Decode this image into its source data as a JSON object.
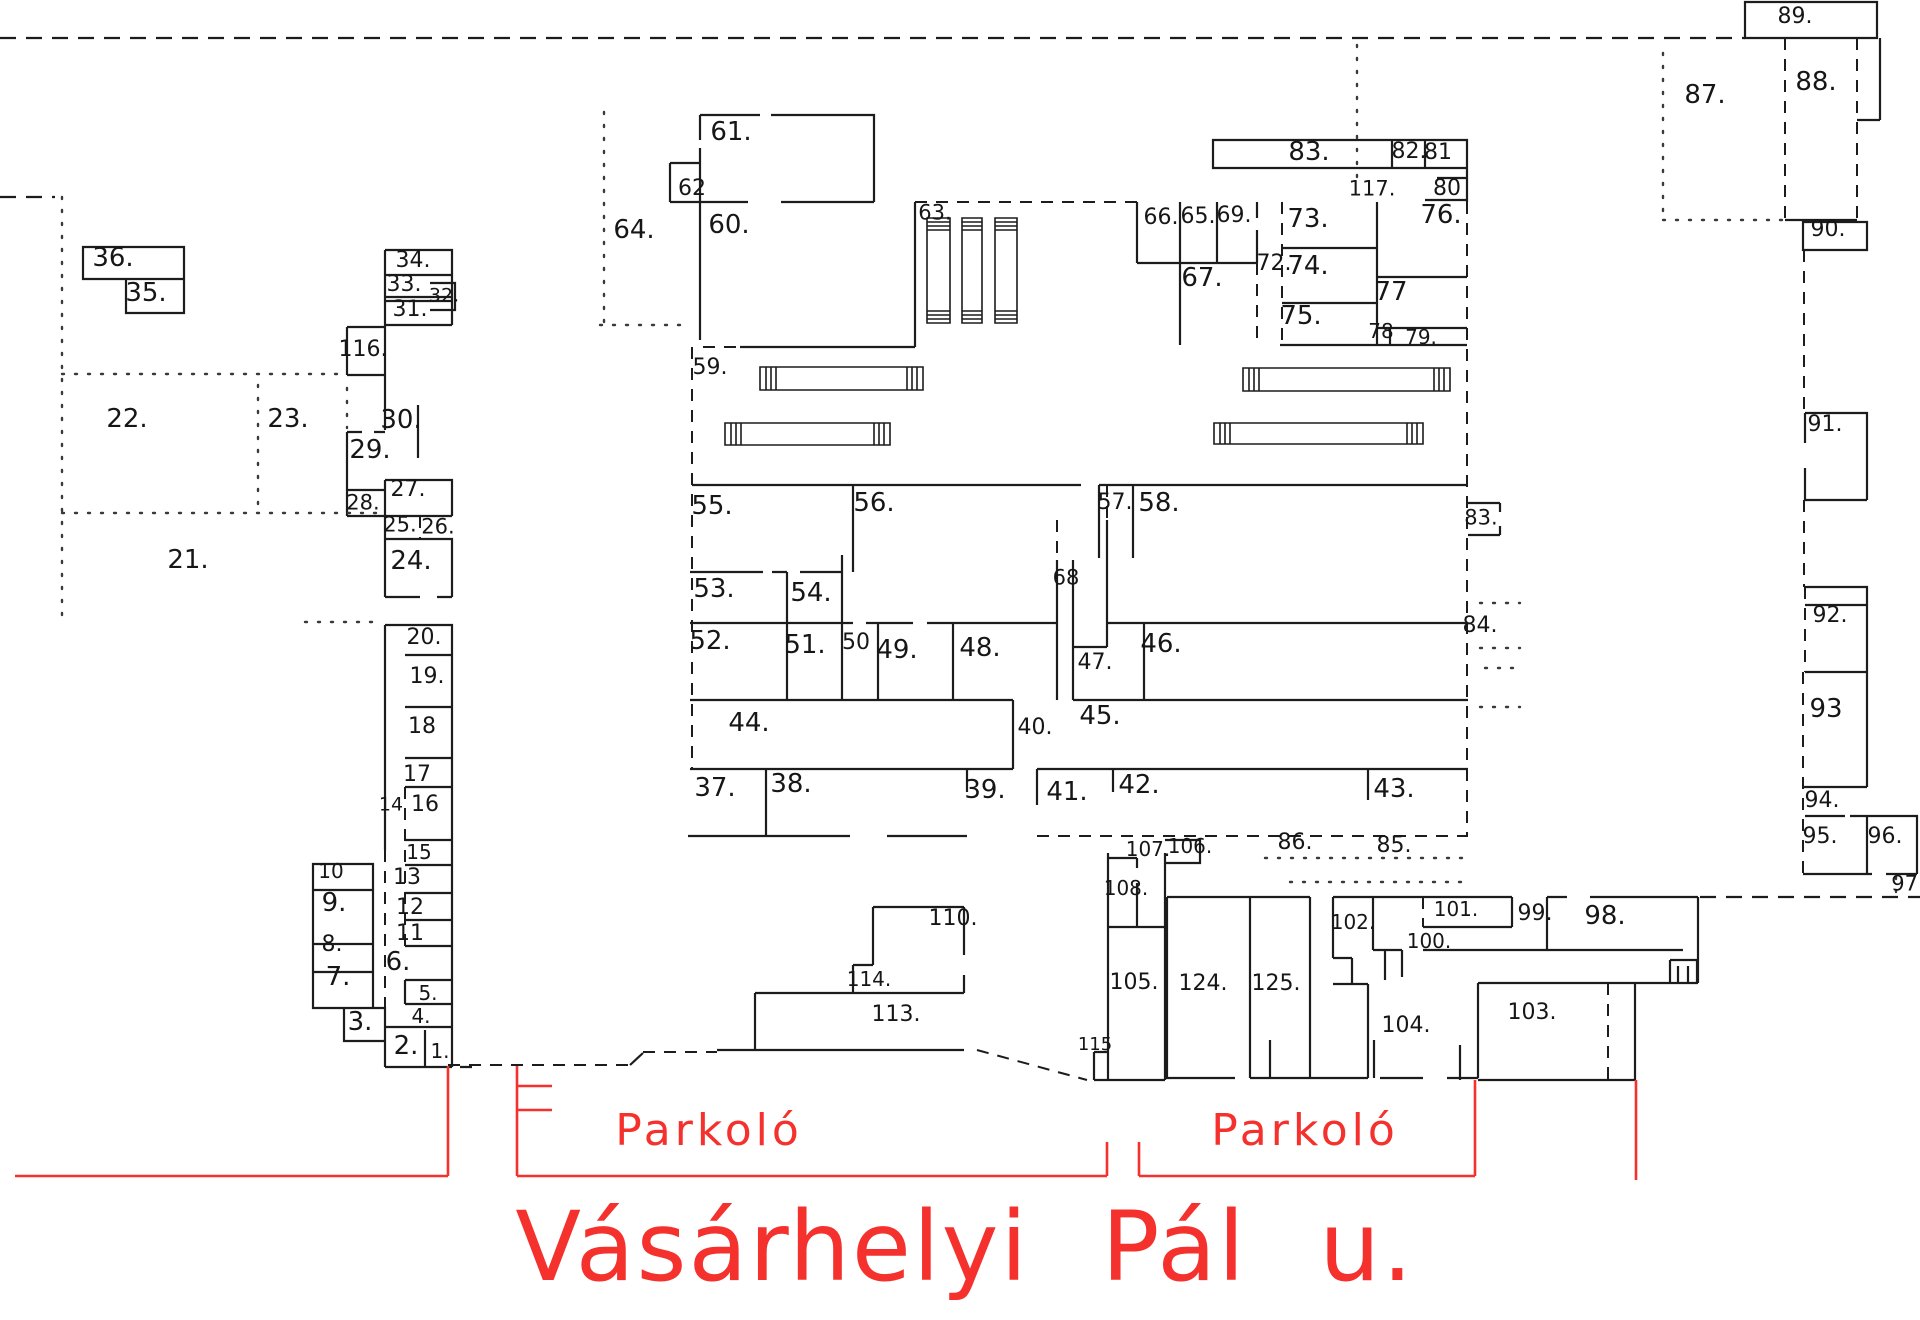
{
  "drawing": {
    "type": "cadastral site plan",
    "street": {
      "name": "Vásárhelyi Pál u."
    },
    "parking": {
      "label": "Parkoló"
    },
    "colors": {
      "wall": "#1c1c1c",
      "annotation_red": "#f5312d",
      "background": "#ffffff"
    }
  },
  "plots": [
    {
      "t": "36.",
      "x": 113,
      "y": 258
    },
    {
      "t": "35.",
      "x": 146,
      "y": 293
    },
    {
      "t": "22.",
      "x": 127,
      "y": 419
    },
    {
      "t": "23.",
      "x": 288,
      "y": 419
    },
    {
      "t": "21.",
      "x": 188,
      "y": 560
    },
    {
      "t": "116.",
      "x": 363,
      "y": 350,
      "fs": 22
    },
    {
      "t": "34.",
      "x": 413,
      "y": 261,
      "fs": 22
    },
    {
      "t": "33.",
      "x": 404,
      "y": 285,
      "fs": 22
    },
    {
      "t": "32.",
      "x": 444,
      "y": 296,
      "fs": 19
    },
    {
      "t": "31.",
      "x": 410,
      "y": 310,
      "fs": 22
    },
    {
      "t": "30.",
      "x": 401,
      "y": 420
    },
    {
      "t": "29.",
      "x": 370,
      "y": 450
    },
    {
      "t": "27.",
      "x": 408,
      "y": 490,
      "fs": 22
    },
    {
      "t": "28.",
      "x": 363,
      "y": 503,
      "fs": 21
    },
    {
      "t": "25.",
      "x": 400,
      "y": 525,
      "fs": 21
    },
    {
      "t": "26.",
      "x": 438,
      "y": 527,
      "fs": 21
    },
    {
      "t": "24.",
      "x": 411,
      "y": 561
    },
    {
      "t": "20.",
      "x": 424,
      "y": 638,
      "fs": 22
    },
    {
      "t": "19.",
      "x": 427,
      "y": 677,
      "fs": 22
    },
    {
      "t": "18",
      "x": 422,
      "y": 727,
      "fs": 22
    },
    {
      "t": "17",
      "x": 417,
      "y": 775,
      "fs": 22
    },
    {
      "t": "14",
      "x": 391,
      "y": 805,
      "fs": 19
    },
    {
      "t": "16",
      "x": 425,
      "y": 805,
      "fs": 22
    },
    {
      "t": "15",
      "x": 419,
      "y": 852,
      "fs": 20
    },
    {
      "t": "13",
      "x": 407,
      "y": 878,
      "fs": 22
    },
    {
      "t": "12",
      "x": 410,
      "y": 908,
      "fs": 22
    },
    {
      "t": "11",
      "x": 410,
      "y": 934,
      "fs": 22
    },
    {
      "t": "10",
      "x": 331,
      "y": 871,
      "fs": 20
    },
    {
      "t": "9.",
      "x": 334,
      "y": 903
    },
    {
      "t": "8.",
      "x": 332,
      "y": 945,
      "fs": 22
    },
    {
      "t": "7.",
      "x": 338,
      "y": 977
    },
    {
      "t": "6.",
      "x": 398,
      "y": 962
    },
    {
      "t": "5.",
      "x": 428,
      "y": 993,
      "fs": 20
    },
    {
      "t": "4.",
      "x": 421,
      "y": 1016,
      "fs": 20
    },
    {
      "t": "3.",
      "x": 360,
      "y": 1022
    },
    {
      "t": "2.",
      "x": 406,
      "y": 1046
    },
    {
      "t": "1.",
      "x": 440,
      "y": 1051,
      "fs": 20
    },
    {
      "t": "61.",
      "x": 731,
      "y": 132
    },
    {
      "t": "62",
      "x": 692,
      "y": 189,
      "fs": 22
    },
    {
      "t": "60.",
      "x": 729,
      "y": 225
    },
    {
      "t": "64.",
      "x": 634,
      "y": 230
    },
    {
      "t": "63.",
      "x": 935,
      "y": 213,
      "fs": 21
    },
    {
      "t": "59.",
      "x": 710,
      "y": 368,
      "fs": 22
    },
    {
      "t": "66.",
      "x": 1161,
      "y": 218,
      "fs": 22
    },
    {
      "t": "65.",
      "x": 1198,
      "y": 217,
      "fs": 22
    },
    {
      "t": "69.",
      "x": 1234,
      "y": 216,
      "fs": 22
    },
    {
      "t": "67.",
      "x": 1202,
      "y": 278
    },
    {
      "t": "72.",
      "x": 1274,
      "y": 264,
      "fs": 22
    },
    {
      "t": "73.",
      "x": 1308,
      "y": 219
    },
    {
      "t": "74.",
      "x": 1308,
      "y": 266
    },
    {
      "t": "75.",
      "x": 1301,
      "y": 316
    },
    {
      "t": "77",
      "x": 1391,
      "y": 292
    },
    {
      "t": "78",
      "x": 1381,
      "y": 331,
      "fs": 20
    },
    {
      "t": "79.",
      "x": 1421,
      "y": 337,
      "fs": 20
    },
    {
      "t": "83.",
      "x": 1309,
      "y": 152
    },
    {
      "t": "82.",
      "x": 1409,
      "y": 152,
      "fs": 22
    },
    {
      "t": "81",
      "x": 1438,
      "y": 153,
      "fs": 22
    },
    {
      "t": "117.",
      "x": 1372,
      "y": 189,
      "fs": 21
    },
    {
      "t": "80",
      "x": 1447,
      "y": 189,
      "fs": 22
    },
    {
      "t": "76.",
      "x": 1441,
      "y": 215
    },
    {
      "t": "55.",
      "x": 712,
      "y": 506
    },
    {
      "t": "56.",
      "x": 874,
      "y": 503
    },
    {
      "t": "57.",
      "x": 1115,
      "y": 503,
      "fs": 22
    },
    {
      "t": "58.",
      "x": 1159,
      "y": 503
    },
    {
      "t": "68",
      "x": 1066,
      "y": 578,
      "fs": 21
    },
    {
      "t": "83.",
      "x": 1481,
      "y": 518,
      "fs": 21
    },
    {
      "t": "84.",
      "x": 1480,
      "y": 626,
      "fs": 22
    },
    {
      "t": "53.",
      "x": 714,
      "y": 589
    },
    {
      "t": "54.",
      "x": 811,
      "y": 593
    },
    {
      "t": "52.",
      "x": 710,
      "y": 641
    },
    {
      "t": "51.",
      "x": 805,
      "y": 645
    },
    {
      "t": "50",
      "x": 856,
      "y": 643,
      "fs": 22
    },
    {
      "t": "49.",
      "x": 897,
      "y": 650
    },
    {
      "t": "48.",
      "x": 980,
      "y": 648
    },
    {
      "t": "47.",
      "x": 1095,
      "y": 663,
      "fs": 22
    },
    {
      "t": "46.",
      "x": 1161,
      "y": 644
    },
    {
      "t": "44.",
      "x": 749,
      "y": 723
    },
    {
      "t": "40.",
      "x": 1035,
      "y": 728,
      "fs": 22
    },
    {
      "t": "45.",
      "x": 1100,
      "y": 716
    },
    {
      "t": "37.",
      "x": 715,
      "y": 788
    },
    {
      "t": "38.",
      "x": 791,
      "y": 784
    },
    {
      "t": "39.",
      "x": 985,
      "y": 790
    },
    {
      "t": "41.",
      "x": 1067,
      "y": 792
    },
    {
      "t": "42.",
      "x": 1139,
      "y": 785
    },
    {
      "t": "43.",
      "x": 1394,
      "y": 789
    },
    {
      "t": "107.",
      "x": 1148,
      "y": 849,
      "fs": 20
    },
    {
      "t": "106.",
      "x": 1190,
      "y": 846,
      "fs": 20
    },
    {
      "t": "86.",
      "x": 1295,
      "y": 843,
      "fs": 22
    },
    {
      "t": "85.",
      "x": 1394,
      "y": 846,
      "fs": 22
    },
    {
      "t": "108.",
      "x": 1126,
      "y": 888,
      "fs": 20
    },
    {
      "t": "110.",
      "x": 953,
      "y": 919,
      "fs": 22
    },
    {
      "t": "114.",
      "x": 869,
      "y": 979,
      "fs": 20
    },
    {
      "t": "113.",
      "x": 896,
      "y": 1015,
      "fs": 22
    },
    {
      "t": "105.",
      "x": 1134,
      "y": 983,
      "fs": 22
    },
    {
      "t": "115",
      "x": 1095,
      "y": 1045,
      "fs": 18
    },
    {
      "t": "124.",
      "x": 1203,
      "y": 984,
      "fs": 22
    },
    {
      "t": "125.",
      "x": 1276,
      "y": 984,
      "fs": 22
    },
    {
      "t": "102.",
      "x": 1353,
      "y": 922,
      "fs": 20
    },
    {
      "t": "101.",
      "x": 1456,
      "y": 909,
      "fs": 20
    },
    {
      "t": "100.",
      "x": 1429,
      "y": 941,
      "fs": 20
    },
    {
      "t": "99.",
      "x": 1535,
      "y": 914,
      "fs": 22
    },
    {
      "t": "98.",
      "x": 1605,
      "y": 916
    },
    {
      "t": "104.",
      "x": 1406,
      "y": 1026,
      "fs": 22
    },
    {
      "t": "103.",
      "x": 1532,
      "y": 1013,
      "fs": 22
    },
    {
      "t": "89.",
      "x": 1795,
      "y": 17,
      "fs": 22
    },
    {
      "t": "88.",
      "x": 1816,
      "y": 82
    },
    {
      "t": "87.",
      "x": 1705,
      "y": 95
    },
    {
      "t": "90.",
      "x": 1828,
      "y": 230,
      "fs": 22
    },
    {
      "t": "91.",
      "x": 1825,
      "y": 425,
      "fs": 22
    },
    {
      "t": "92.",
      "x": 1830,
      "y": 616,
      "fs": 22
    },
    {
      "t": "93",
      "x": 1826,
      "y": 709
    },
    {
      "t": "94.",
      "x": 1822,
      "y": 801,
      "fs": 22
    },
    {
      "t": "95.",
      "x": 1820,
      "y": 837,
      "fs": 22
    },
    {
      "t": "96.",
      "x": 1885,
      "y": 837,
      "fs": 22
    },
    {
      "t": "97.",
      "x": 1908,
      "y": 884,
      "fs": 21
    }
  ]
}
